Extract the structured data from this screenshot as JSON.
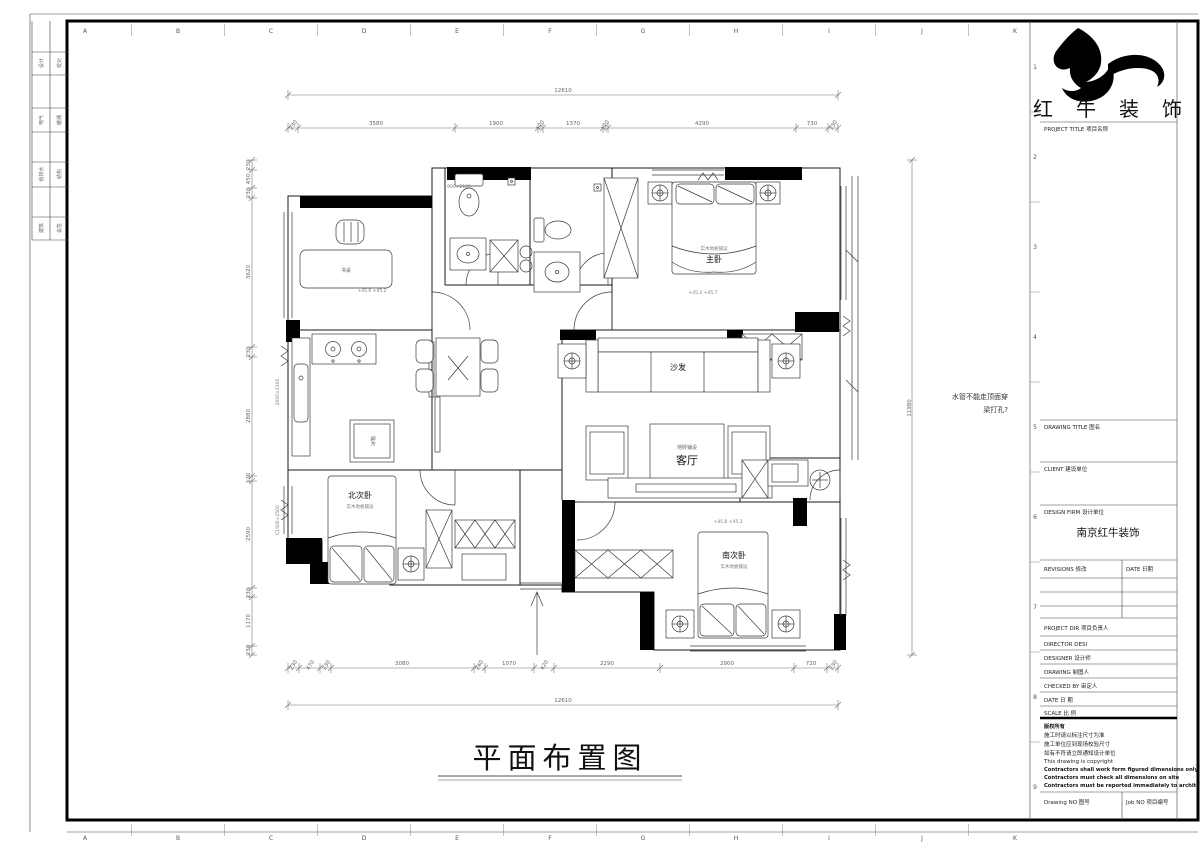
{
  "sheet": {
    "grid_letters": [
      "A",
      "B",
      "C",
      "D",
      "E",
      "F",
      "G",
      "H",
      "I",
      "J",
      "K"
    ],
    "grid_numbers": [
      "1",
      "2",
      "3",
      "4",
      "5",
      "6",
      "7",
      "8",
      "9"
    ],
    "signature_strip": {
      "rows": [
        {
          "left": "设计",
          "right": "校对"
        },
        {
          "left": "电气",
          "right": "暖通"
        },
        {
          "left": "给排水",
          "right": "结构"
        },
        {
          "left": "建筑",
          "right": "会签"
        }
      ]
    }
  },
  "title_block": {
    "company_name": "红 牛 装 饰",
    "project_title_label": "PROJECT TITLE  项目名称",
    "drawing_title_label": "DRAWING TITLE  图名",
    "client_label": "CLIENT  建设单位",
    "design_firm_label": "DESIGN FIRM  设计单位",
    "design_firm_value": "南京红牛装饰",
    "revisions_label": "REVISIONS  修改",
    "revisions_date_label": "DATE  日期",
    "project_dir_label": "PROJECT DIR   项目负责人",
    "director_label": "DIRECTOR DESI",
    "designer_label": "DESIGNER      设计师",
    "drawing_label": "DRAWING       制图人",
    "checked_by_label": "CHECKED BY    审定人",
    "date_label": "DATE          日  期",
    "scale_label": "SCALE         比  例",
    "notes": [
      "版权所有",
      "施工时请以标注尺寸为准",
      "施工单位应到现场校验尺寸",
      "如有不符请立即通知设计单位",
      "This drawing is copyright",
      "Contractors shall work form figured dimensions only",
      "Contractors must check all dimensions on site",
      "Contractors must be reported immediately to architects"
    ],
    "drawing_no_label": "Drawing NO  图号",
    "job_no_label": "Job NO  项目编号"
  },
  "plan": {
    "drawing_title": "平面布置图",
    "labels": {
      "living_room": "客厅",
      "living_floor": "地砖铺设",
      "sofa": "沙发",
      "master_bedroom": "主卧",
      "master_floor": "实木地板铺设",
      "north_bedroom": "北次卧",
      "north_floor": "实木地板铺设",
      "south_bedroom": "南次卧",
      "south_floor": "实木地板铺设",
      "desk": "书桌",
      "fridge": "冰箱"
    },
    "annotations": {
      "pipe_note_line1": "水管不能走顶面穿",
      "pipe_note_line2": "梁打孔?",
      "elev_master": "+45.2  +45.7",
      "elev_south": "+45.8  +45.3",
      "elev_study": "+45.6  +45.2",
      "window_spec_left_upper": "2000×2100",
      "window_spec_left_lower": "C1500×1500",
      "door_spec": "900×2100"
    },
    "dims": {
      "top_overall": "12610",
      "bottom_overall": "12610",
      "right_overall": "11980",
      "top_chain": [
        "230",
        "3580",
        "1900",
        "120",
        "1370",
        "120",
        "4290",
        "730",
        "230"
      ],
      "bottom_chain": [
        "230",
        "470",
        "230",
        "3080",
        "240",
        "1070",
        "420",
        "2290",
        "2900",
        "720",
        "230"
      ],
      "left_chain": [
        "230",
        "450",
        "230",
        "3620",
        "230",
        "2880",
        "120",
        "2590",
        "230",
        "1170",
        "230"
      ]
    }
  }
}
